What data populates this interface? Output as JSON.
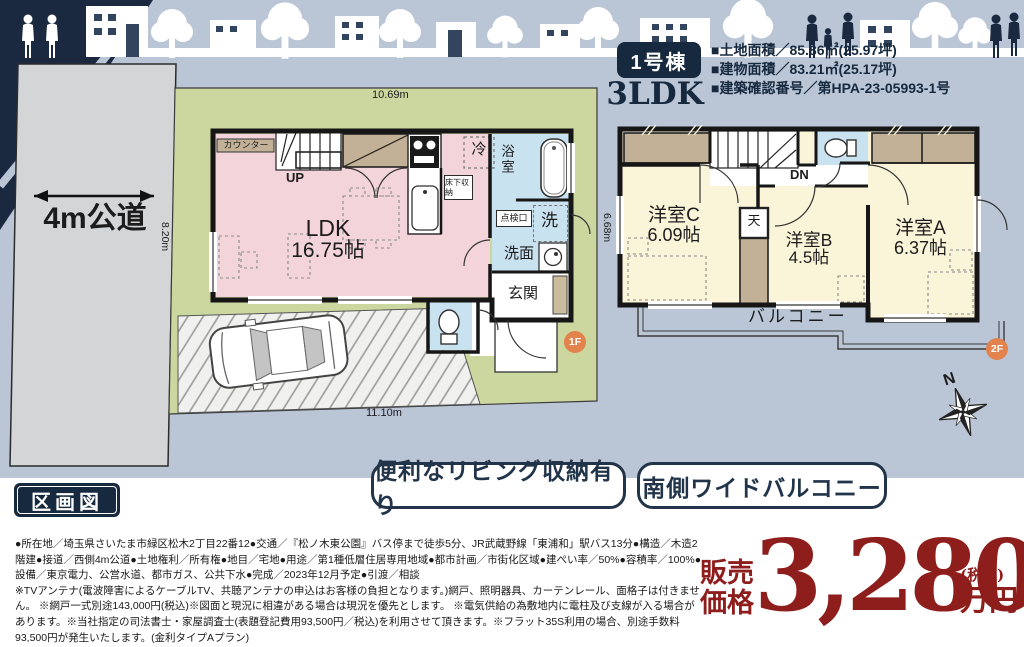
{
  "header": {
    "badge": "1号棟",
    "plan_type": "3LDK",
    "specs": [
      "■土地面積／85.86㎡(25.97坪)",
      "■建物面積／83.21㎡(25.17坪)",
      "■建築確認番号／第HPA-23-05993-1号"
    ]
  },
  "site": {
    "road_label": "4m公道",
    "dim_top": "10.69m",
    "dim_left": "8.20m",
    "dim_bottom": "11.10m",
    "dim_left_2f": "6.68m",
    "north": "N",
    "section_label": "区画図"
  },
  "floor1": {
    "badge": "1F",
    "counter": "カウンター",
    "up": "UP",
    "ldk_name": "LDK",
    "ldk_size": "16.75帖",
    "fridge": "冷",
    "underfloor": "床下収納",
    "bath": "浴室",
    "hatch": "点検口",
    "washer": "洗",
    "washroom": "洗面",
    "entrance": "玄関"
  },
  "floor2": {
    "badge": "2F",
    "down": "DN",
    "room_c_name": "洋室C",
    "room_c_size": "6.09帖",
    "ceiling_box": "天",
    "room_b_name": "洋室B",
    "room_b_size": "4.5帖",
    "room_a_name": "洋室A",
    "room_a_size": "6.37帖",
    "balcony": "バルコニー"
  },
  "features": [
    "便利なリビング収納有り",
    "南側ワイドバルコニー"
  ],
  "description": {
    "para1": "●所在地／埼玉県さいたま市緑区松木2丁目22番12●交通／『松ノ木東公園』バス停まで徒歩5分、JR武蔵野線「東浦和」駅バス13分●構造／木造2階建●接道／西側4m公道●土地権利／所有権●地目／宅地●用途／第1種低層住居専用地域●都市計画／市街化区域●建ぺい率／50%●容積率／100%●設備／東京電力、公営水道、都市ガス、公共下水●完成／2023年12月予定●引渡／相談",
    "para2": "※TVアンテナ(電波障害によるケーブルTV、共聴アンテナの申込はお客様の負担となります。)網戸、照明器具、カーテンレール、面格子は付きません。 ※網戸一式別途143,000円(税込)※図面と現況に相違がある場合は現況を優先とします。 ※電気供給の為敷地内に電柱及び支線が入る場合があります。※当社指定の司法書士・家屋調査士(表題登記費用93,500円／税込)を利用させて頂きます。※フラット35S利用の場合、別途手数料93,500円が発生いたします。(金利タイプAプラン)"
  },
  "price": {
    "label_line1": "販売",
    "label_line2": "価格",
    "amount": "3,280",
    "tax_note": "(税込)",
    "unit": "万円"
  },
  "colors": {
    "navy": "#16293e",
    "sky": "#bac6d6",
    "lot_green": "#ccd7a0",
    "road_gray": "#d4d5d7",
    "ldk_pink": "#f2d4da",
    "wet_blue": "#c9e2ef",
    "room_cream": "#faf4d9",
    "closet_tan": "#c2b196",
    "badge_orange": "#e2824d",
    "price_red": "#8e1e1c"
  }
}
